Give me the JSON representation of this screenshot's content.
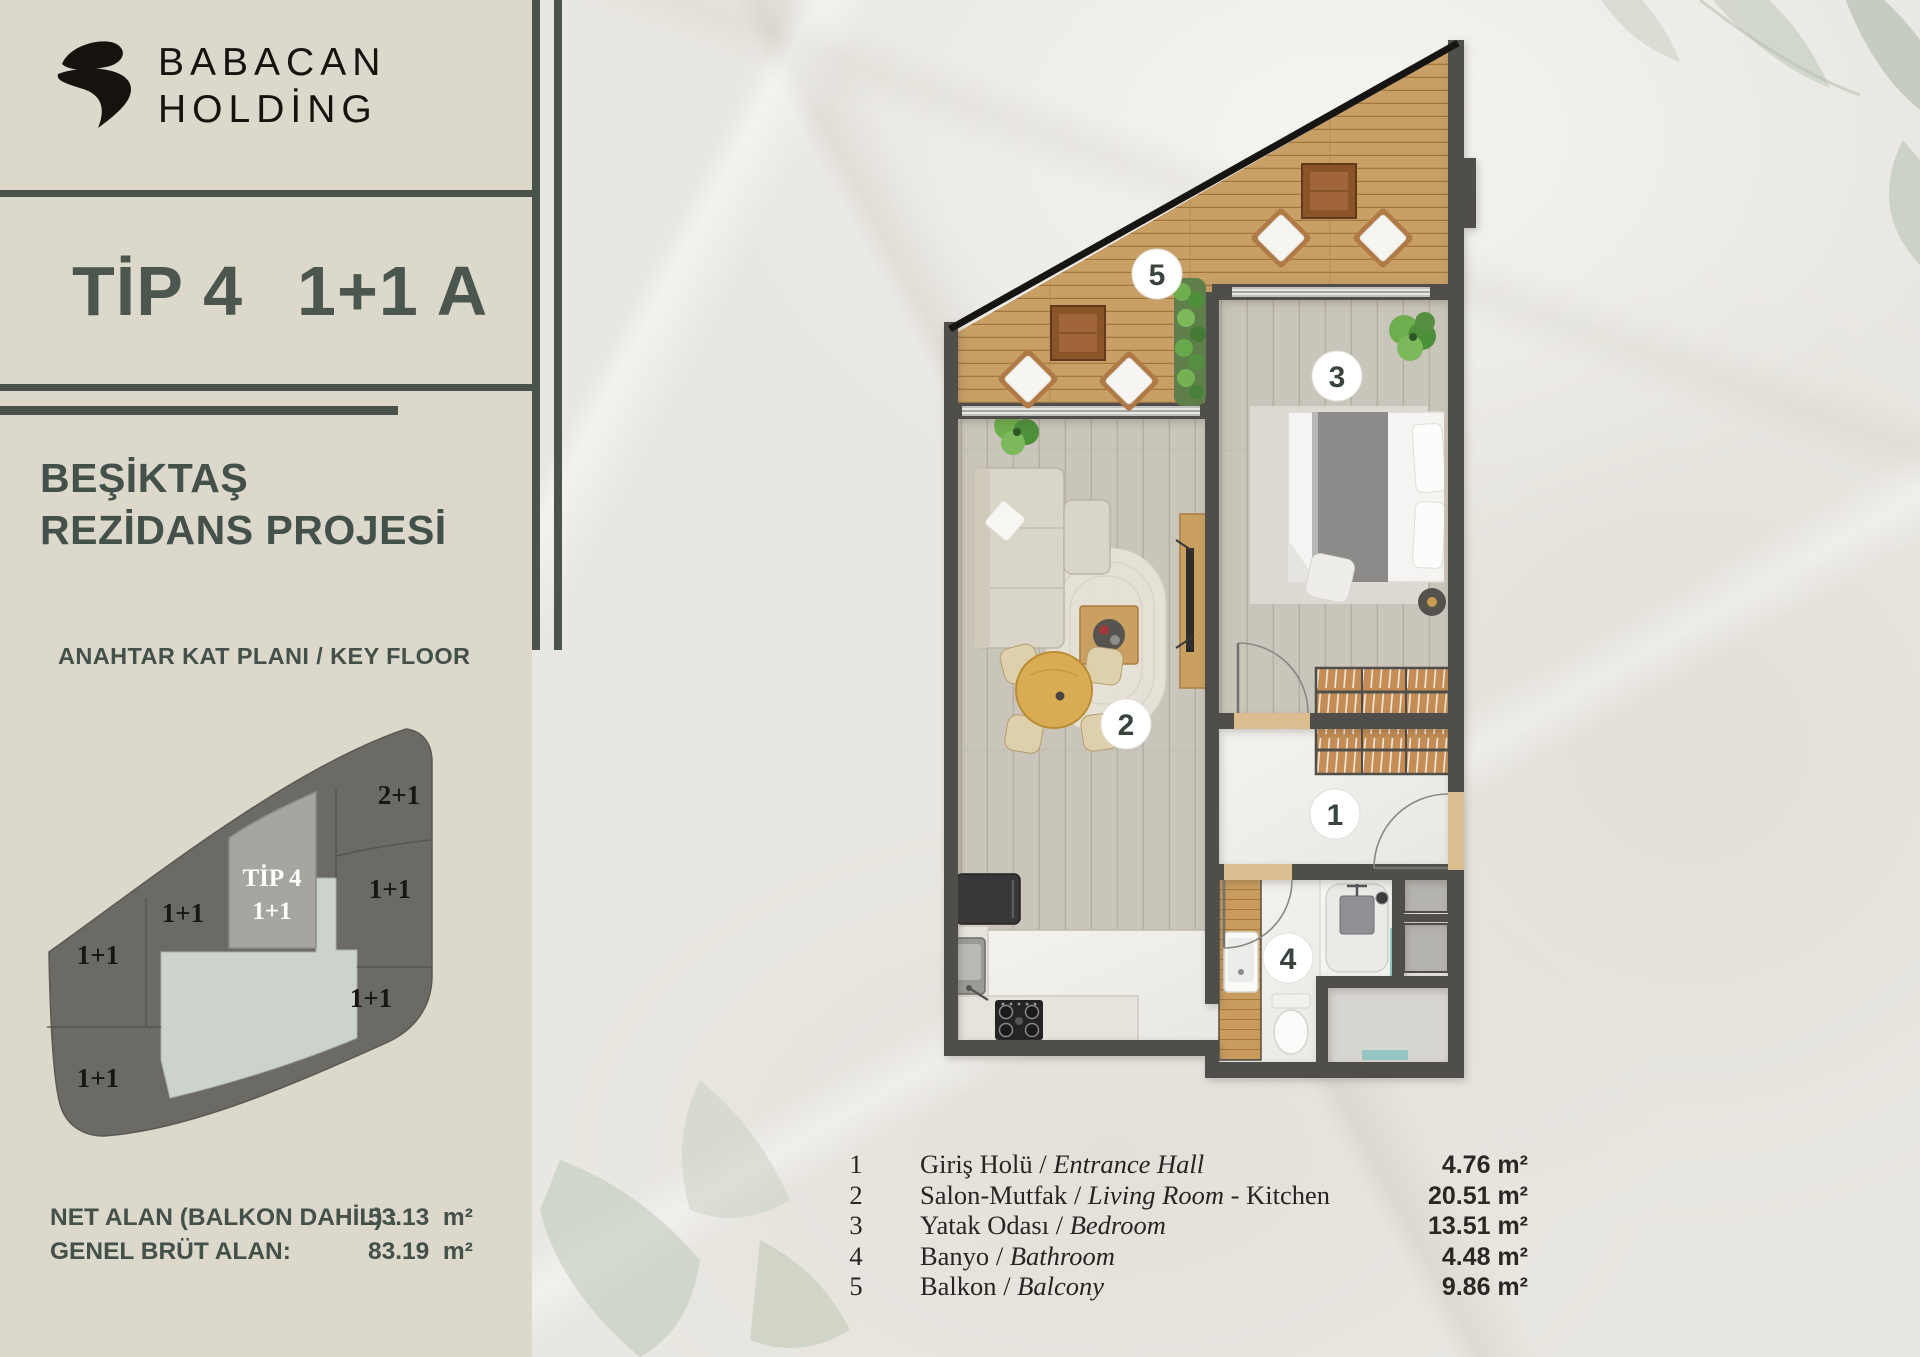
{
  "brand": {
    "line1": "BABACAN",
    "line2": "HOLDİNG"
  },
  "title": {
    "type": "TİP 4",
    "variant": "1+1 A"
  },
  "project": {
    "line1": "BEŞİKTAŞ",
    "line2": "REZİDANS PROJESİ"
  },
  "key_plan": {
    "caption": "ANAHTAR KAT PLANI / KEY FLOOR",
    "highlight": {
      "line1": "TİP 4",
      "line2": "1+1"
    },
    "units": [
      {
        "label": "2+1"
      },
      {
        "label": "1+1"
      },
      {
        "label": "1+1"
      },
      {
        "label": "1+1"
      },
      {
        "label": "1+1"
      },
      {
        "label": "1+1"
      }
    ]
  },
  "areas": {
    "net_label": "NET ALAN (BALKON DAHİL) : ",
    "net_value": "53.13  m²",
    "gross_label": "GENEL BRÜT ALAN:",
    "gross_value": "83.19  m²"
  },
  "plan": {
    "badges": [
      {
        "n": "1"
      },
      {
        "n": "2"
      },
      {
        "n": "3"
      },
      {
        "n": "4"
      },
      {
        "n": "5"
      }
    ]
  },
  "legend": {
    "rows": [
      {
        "num": "1",
        "name_tr": "Giriş Holü",
        "sep": " / ",
        "name_en": "Entrance Hall",
        "extra": "",
        "area": "4.76 m²"
      },
      {
        "num": "2",
        "name_tr": "Salon-Mutfak",
        "sep": " / ",
        "name_en": "Living Room",
        "extra": " - Kitchen",
        "area": "20.51 m²"
      },
      {
        "num": "3",
        "name_tr": "Yatak Odası",
        "sep": " / ",
        "name_en": "Bedroom",
        "extra": "",
        "area": "13.51 m²"
      },
      {
        "num": "4",
        "name_tr": "Banyo",
        "sep": " / ",
        "name_en": "Bathroom",
        "extra": "",
        "area": "4.48 m²"
      },
      {
        "num": "5",
        "name_tr": "Balkon",
        "sep": " / ",
        "name_en": "Balcony",
        "extra": "",
        "area": "9.86 m²"
      }
    ]
  },
  "colors": {
    "accent": "#47524a",
    "wall": "#504e4a",
    "deck": "#c8a066",
    "sage": "#ccd3ca",
    "key_blob": "#6b6a64",
    "highlight_unit": "#a6a5a0"
  }
}
